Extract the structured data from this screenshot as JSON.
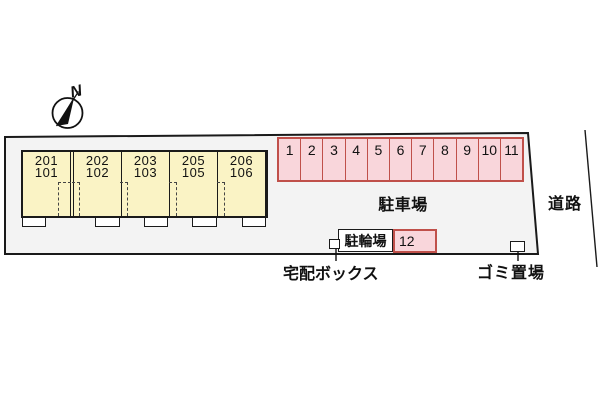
{
  "compass": {
    "north_label": "N"
  },
  "site": {
    "building": {
      "units": [
        {
          "upper": "201",
          "lower": "101"
        },
        {
          "upper": "202",
          "lower": "102"
        },
        {
          "upper": "203",
          "lower": "103"
        },
        {
          "upper": "205",
          "lower": "105"
        },
        {
          "upper": "206",
          "lower": "106"
        }
      ]
    },
    "parking": {
      "label": "駐車場",
      "space_numbers": [
        "1",
        "2",
        "3",
        "4",
        "5",
        "6",
        "7",
        "8",
        "9",
        "10",
        "11"
      ],
      "extra_space_number": "12"
    },
    "bicycle_parking": {
      "label": "駐輪場"
    },
    "delivery_box": {
      "label": "宅配ボックス"
    },
    "garbage_area": {
      "label": "ゴミ置場"
    },
    "road": {
      "label": "道路"
    }
  },
  "colors": {
    "plot_fill": "#f3f3f3",
    "outline": "#1a1a1a",
    "building_fill": "#faf3c5",
    "parking_fill": "#f9d6db",
    "parking_border": "#c0504a"
  }
}
